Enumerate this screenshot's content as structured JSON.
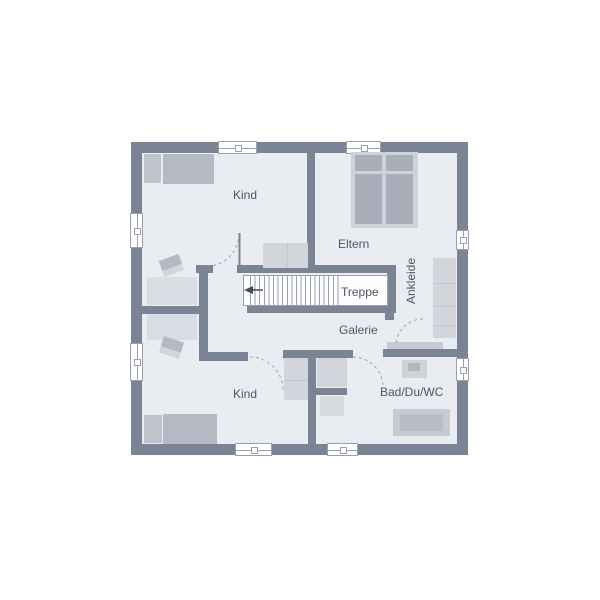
{
  "rooms": {
    "kind_top": {
      "label": "Kind"
    },
    "kind_bottom": {
      "label": "Kind"
    },
    "eltern": {
      "label": "Eltern"
    },
    "ankleide": {
      "label": "Ankleide"
    },
    "bad": {
      "label": "Bad/Du/WC"
    },
    "galerie": {
      "label": "Galerie"
    },
    "treppe": {
      "label": "Treppe"
    }
  },
  "colors": {
    "wall": "#7b8494",
    "floor": "#e9ecf1",
    "window": "#ffffff",
    "window-frame": "#9aa1ae",
    "furniture-mid": "#b4b9c4",
    "furniture-light": "#d2d5db",
    "bed-frame": "#ced2d9",
    "bed-inner": "#a9aebb",
    "pillow": "#bfc3cc",
    "desk": "#dadde3",
    "stair-line": "#98a0ad",
    "arc": "#9aa4b2",
    "text": "#4d5565"
  }
}
